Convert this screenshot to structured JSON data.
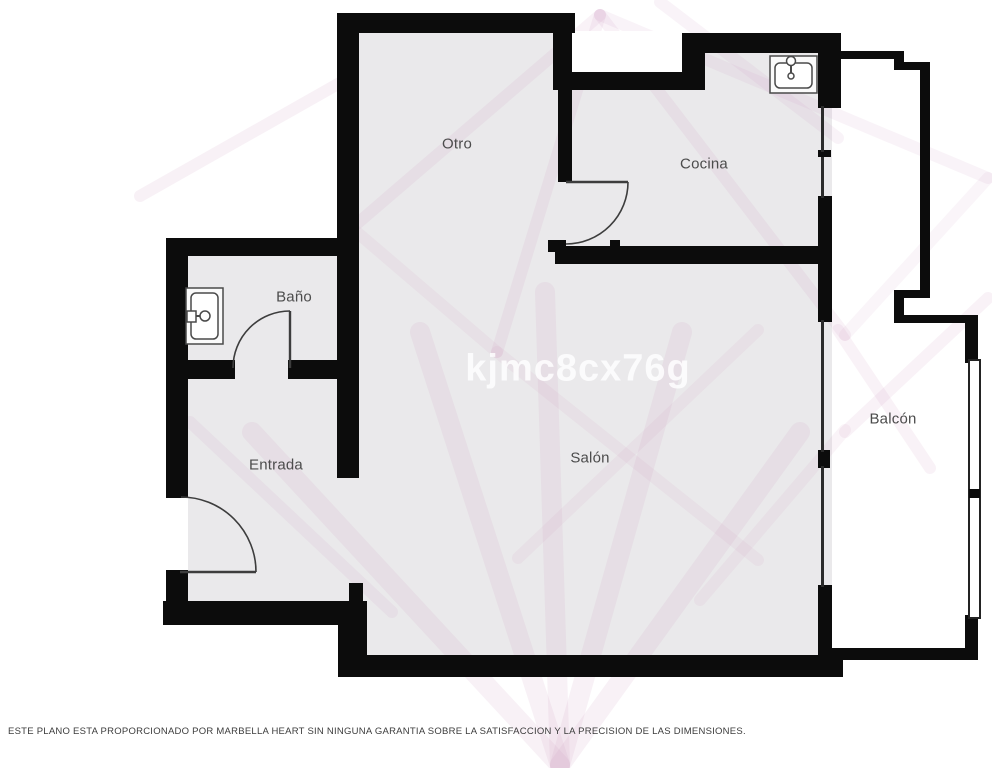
{
  "meta": {
    "type": "floor-plan"
  },
  "colors": {
    "wall": "#0c0c0c",
    "floor": "#eae9eb",
    "label": "#4c4c4c",
    "door": "#3d3d3d",
    "watermark_pink": "#cf9ec2",
    "watermark_text": "rgba(255,255,255,0.82)"
  },
  "rooms": [
    {
      "id": "otro",
      "label": "Otro"
    },
    {
      "id": "cocina",
      "label": "Cocina"
    },
    {
      "id": "bano",
      "label": "Baño"
    },
    {
      "id": "entrada",
      "label": "Entrada"
    },
    {
      "id": "salon",
      "label": "Salón"
    },
    {
      "id": "balcon",
      "label": "Balcón"
    }
  ],
  "fixtures": [
    {
      "id": "bathroom-sink",
      "icon": "sink-icon",
      "room": "Baño"
    },
    {
      "id": "kitchen-sink",
      "icon": "sink-icon",
      "room": "Cocina"
    }
  ],
  "watermark": {
    "code": "kjmc8cx76g"
  },
  "footer": {
    "disclaimer": "ESTE PLANO ESTA PROPORCIONADO POR MARBELLA HEART SIN NINGUNA GARANTIA SOBRE LA SATISFACCION Y LA PRECISION DE LAS DIMENSIONES."
  }
}
